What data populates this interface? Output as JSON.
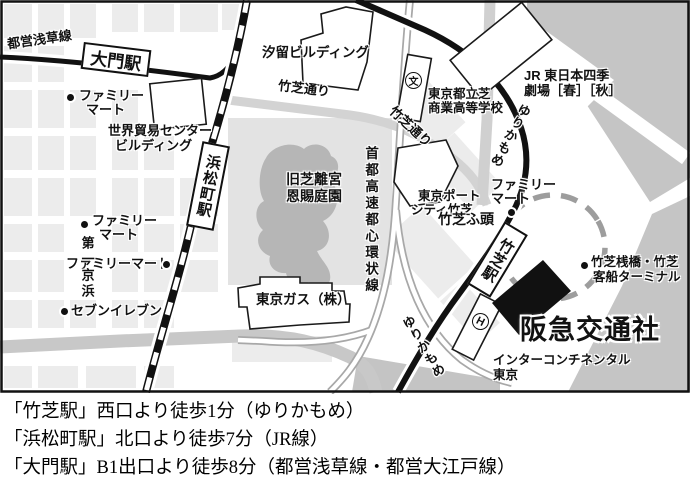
{
  "labels": {
    "toei_asakusa_line": "都営浅草線",
    "daimon_station": "大門駅",
    "hamamatsucho_station": "浜松町駅",
    "takeshiba_station": "竹芝駅",
    "shiodome_building": "汐留ビルディング",
    "takeshiba_dori_a": "竹芝通り",
    "takeshiba_dori_b": "竹芝通り",
    "wtc_1": "世界貿易センター",
    "wtc_2": "ビルディング",
    "famima_a1": "ファミリー",
    "famima_a2": "マート",
    "famima_b1": "ファミリー",
    "famima_b2": "マート",
    "famima_c": "ファミリーマート",
    "famima_d1": "ファミリー",
    "famima_d2": "マート",
    "seven_eleven": "セブンイレブン",
    "daiichi_keihin": "第一京浜",
    "kyu_shiba_1": "旧芝離宮",
    "kyu_shiba_2": "恩賜庭園",
    "shuto_expressway": "首都高速都心環状線",
    "school_1": "東京都立芝",
    "school_2": "商業高等学校",
    "school_symbol": "文",
    "jr_theatre_1": "JR 東日本四季",
    "jr_theatre_2": "劇場［春］［秋］",
    "yurikamome_a": "ゆりかもめ",
    "yurikamome_b": "ゆりかもめ",
    "port_city_1": "東京ポート",
    "port_city_2": "シティ竹芝",
    "takeshiba_pier": "竹芝ふ頭",
    "terminal_1": "竹芝桟橋・竹芝",
    "terminal_2": "客船ターミナル",
    "tokyo_gas": "東京ガス（株）",
    "hankyu": "阪急交通社",
    "intercontinental_1": "インターコンチネンタル",
    "intercontinental_2": "東京",
    "hotel_symbol": "H"
  },
  "directions": [
    "「竹芝駅」西口より徒歩1分（ゆりかもめ）",
    "「浜松町駅」北口より徒歩7分（JR線）",
    "「大門駅」B1出口より徒歩8分（都営浅草線・都営大江戸線）"
  ],
  "colors": {
    "block": "#ececec",
    "park": "#e3e3e3",
    "pond": "#b6b6b6",
    "water": "#c5c5c5",
    "road": "#c8c8c8",
    "expressway": "#a8a8a8",
    "rail": "#111111",
    "pier_dash": "#9d9d9d",
    "hankyu_building": "#111111"
  }
}
